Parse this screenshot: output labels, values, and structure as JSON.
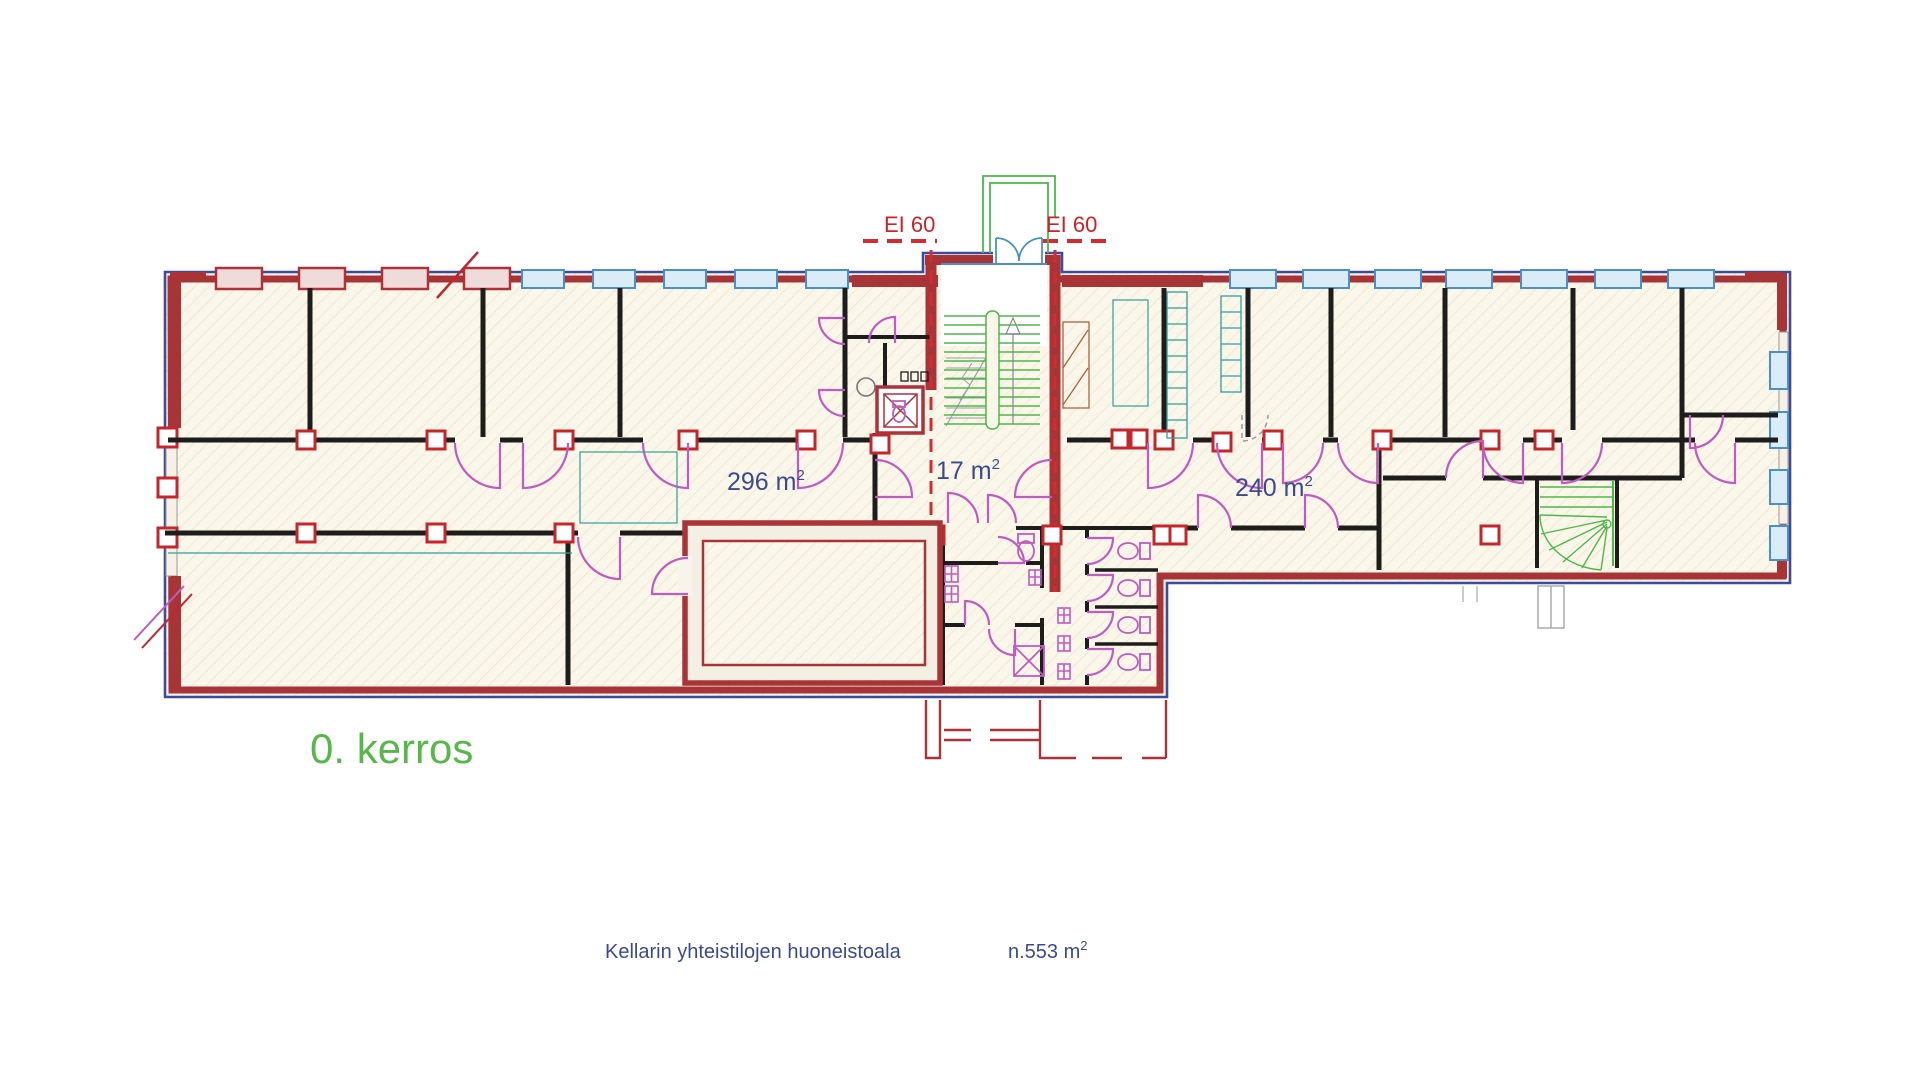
{
  "labels": {
    "ei60_left": "EI 60",
    "ei60_right": "EI 60",
    "area_296": {
      "text": "296 m",
      "sup": "2"
    },
    "area_17": {
      "text": "17 m",
      "sup": "2"
    },
    "area_240": {
      "text": "240 m",
      "sup": "2"
    },
    "floor_title": "0. kerros",
    "footer_caption": "Kellarin yhteistilojen huoneistoala",
    "footer_area": {
      "text": "n.553 m",
      "sup": "2"
    }
  },
  "colors": {
    "exterior_wall_red": "#a93438",
    "exterior_outline_blue": "#3c4ba0",
    "interior_wall_black": "#1d1d1b",
    "door_magenta": "#bf5cbf",
    "window_frame_blue": "#4a90c4",
    "window_fill_blue": "#d9ecf8",
    "window_red": "#b03038",
    "stair_green": "#4db848",
    "fixture_teal": "#2f9e9e",
    "fire_dash_red": "#d42a30",
    "label_blue": "#3b4a8f",
    "title_green": "#56b848",
    "fire_label_red": "#cc2228",
    "floor_cream": "#f8f4e9"
  }
}
